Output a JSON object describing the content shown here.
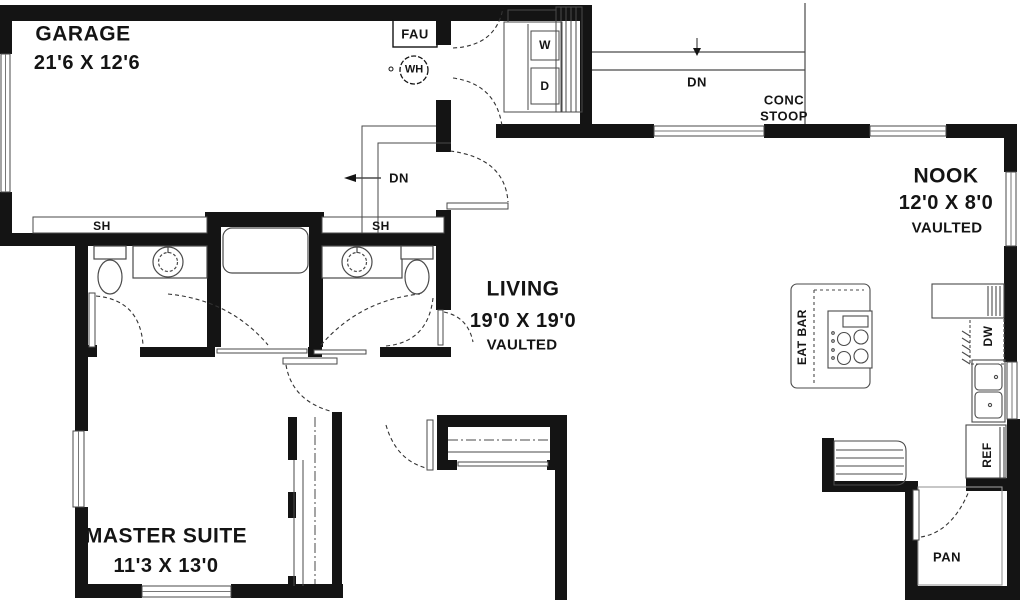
{
  "plan_title": "First floor plan",
  "rooms": {
    "garage": {
      "name": "GARAGE",
      "dims": "21'6 X 12'6"
    },
    "living": {
      "name": "LIVING",
      "dims": "19'0 X 19'0",
      "note": "VAULTED"
    },
    "nook": {
      "name": "NOOK",
      "dims": "12'0 X 8'0",
      "note": "VAULTED"
    },
    "master": {
      "name": "MASTER SUITE",
      "dims": "11'3 X 13'0"
    }
  },
  "labels": {
    "fau": "FAU",
    "wh": "WH",
    "dn_garage": "DN",
    "dn_stoop": "DN",
    "conc_line1": "CONC",
    "conc_line2": "STOOP",
    "washer": "W",
    "dryer": "D",
    "eat_bar": "EAT BAR",
    "dw": "DW",
    "ref": "REF",
    "pan": "PAN",
    "sh_left": "SH",
    "sh_right": "SH"
  },
  "colors": {
    "wall": "#141414",
    "thin_line": "#4a4a4a",
    "background": "#ffffff",
    "text": "#141414"
  }
}
